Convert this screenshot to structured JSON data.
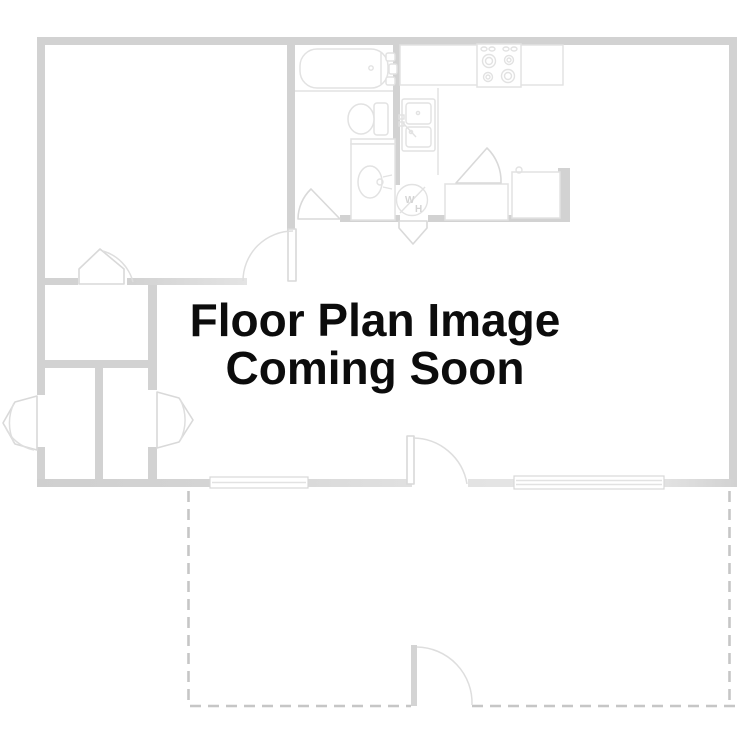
{
  "placeholder": {
    "line1": "Floor Plan Image",
    "line2": "Coming Soon"
  },
  "fixtures": {
    "washer_heater_label_w": "W",
    "washer_heater_label_h": "H"
  },
  "colors": {
    "background": "#ffffff",
    "wall": "#d2d2d2",
    "fixture_outline": "#e2e2e2",
    "door_outline": "#d9d9d9",
    "patio_dashed": "#c6c6c6",
    "title_text": "#0c0c0c"
  }
}
